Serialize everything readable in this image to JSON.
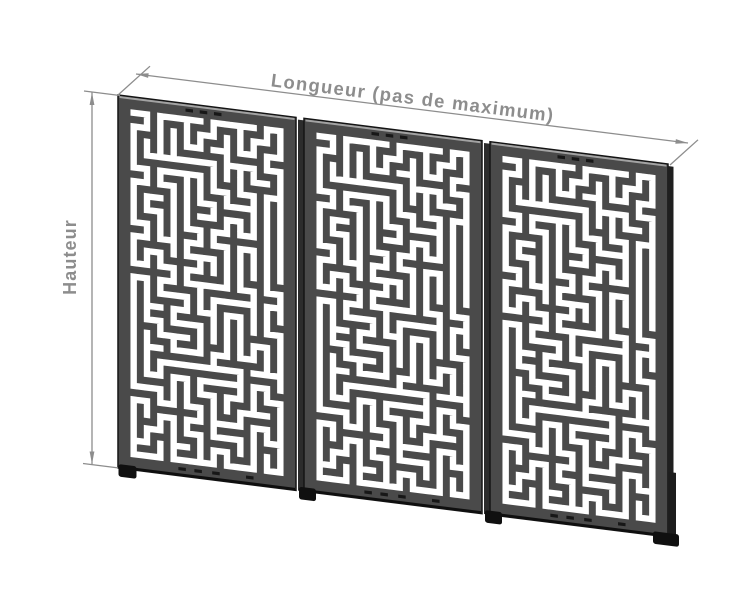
{
  "diagram": {
    "labels": {
      "length": "Longueur (pas de maximum)",
      "height": "Hauteur"
    },
    "panels": {
      "count": 3,
      "identical": true,
      "pattern": {
        "style": "maze",
        "cols": 12,
        "rows": 26,
        "seed": 9,
        "cut_width": 6.4,
        "border": 9
      },
      "slots": {
        "top": [
          0.4,
          0.48,
          0.56
        ],
        "bottom": [
          0.36,
          0.45,
          0.55,
          0.74
        ]
      }
    },
    "colors": {
      "background": "#ffffff",
      "panel_face": "#4a4a4a",
      "panel_edge": "#141414",
      "panel_side": "#2c2c2c",
      "top_highlight": "#a3a3a3",
      "bottom_shadow": "#0f0f0f",
      "hardware": "#101010",
      "slot": "#171717",
      "cut": "#ffffff",
      "annotation": "#8d8d8d"
    }
  }
}
